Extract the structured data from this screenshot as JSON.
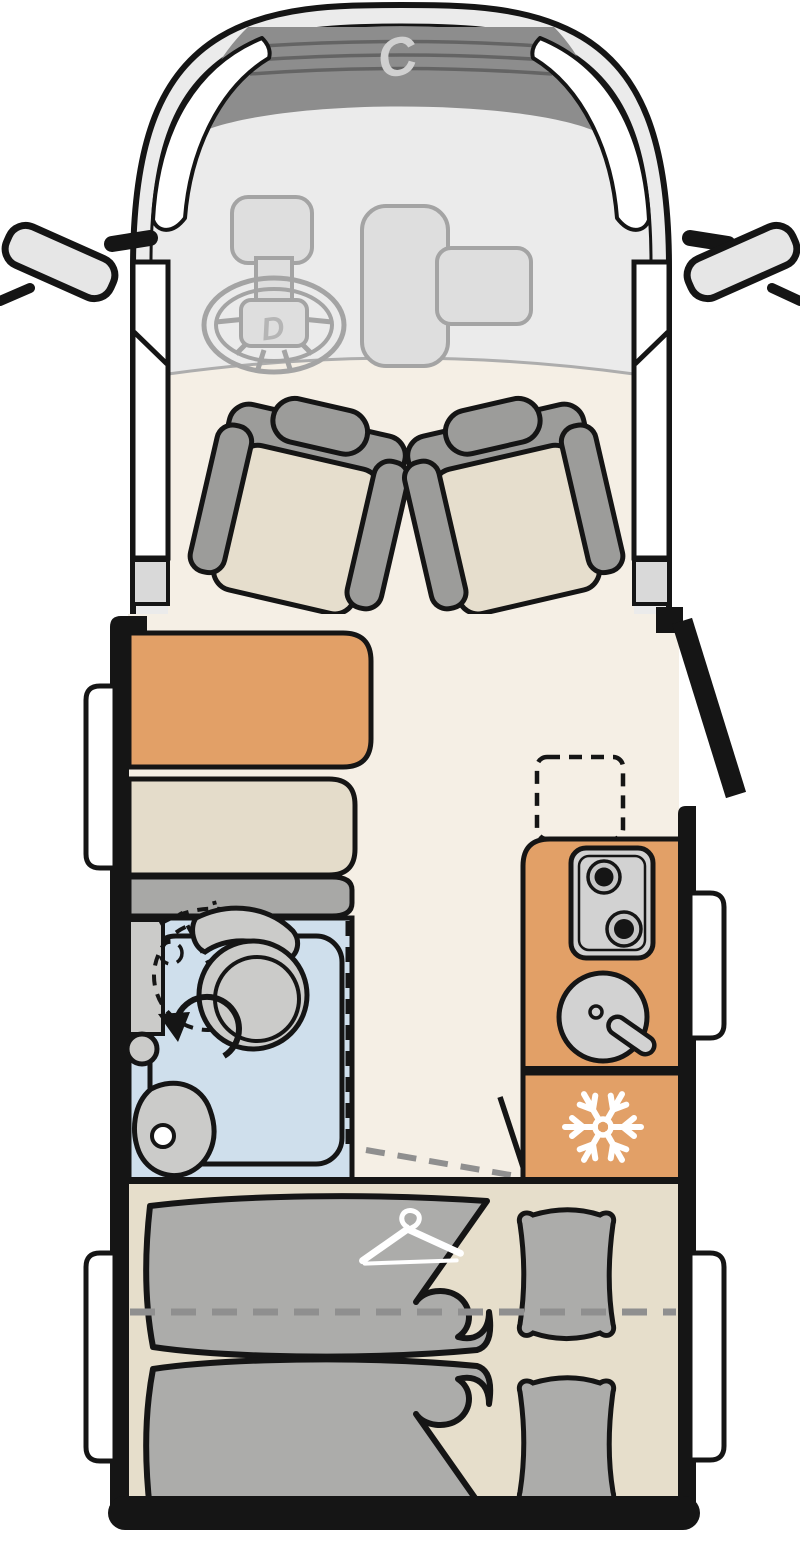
{
  "branding": {
    "front_logo": "C",
    "steering_logo": "D"
  },
  "icons": {
    "snowflake-icon": "refrigerator / freezer compartment",
    "hanger-icon": "wardrobe storage",
    "rotation-arrow-icon": "swivel toilet rotation",
    "burner-icon": "two-burner gas hob",
    "sink-icon": "round kitchen sink with faucet",
    "mirror-icon": "exterior side mirrors"
  },
  "areas": {
    "cab": "driver cab with two swivel seats",
    "dinette": "side bench with table and sideboard",
    "bathroom": "shower room with swivel toilet and washbasin",
    "kitchen": "kitchen block with hob, sink and fridge",
    "bedroom": "two single beds with pillows",
    "entry": "side entry door (shown open)"
  },
  "colors": {
    "ink": "#151515",
    "cab-body": "#ebebeb",
    "cab-detail-fill": "#dedede",
    "cab-detail-stroke": "#a4a4a4",
    "grille": "#8d8d8d",
    "grille-stripe": "#646464",
    "logo": "#d0d0d0",
    "logo-dim": "#b5b5b5",
    "floor": "#f5efe5",
    "orange": "#e2a067",
    "upholstery": "#e6decd",
    "wood-beige": "#e4dcca",
    "bed-base": "#e6decb",
    "seat-gray": "#9c9c9a",
    "cabinet-gray": "#a8a8a6",
    "fixture-gray": "#cbcbc9",
    "appliance-gray": "#d2d2d2",
    "burner-ring": "#c6c6c6",
    "shower-blue": "#cfdfec",
    "duvet-gray": "#acacaa",
    "sill-gray": "#d9d9d9",
    "dash-gray": "#8f8f8f",
    "dashboard-line": "#adadad",
    "white": "#ffffff"
  }
}
